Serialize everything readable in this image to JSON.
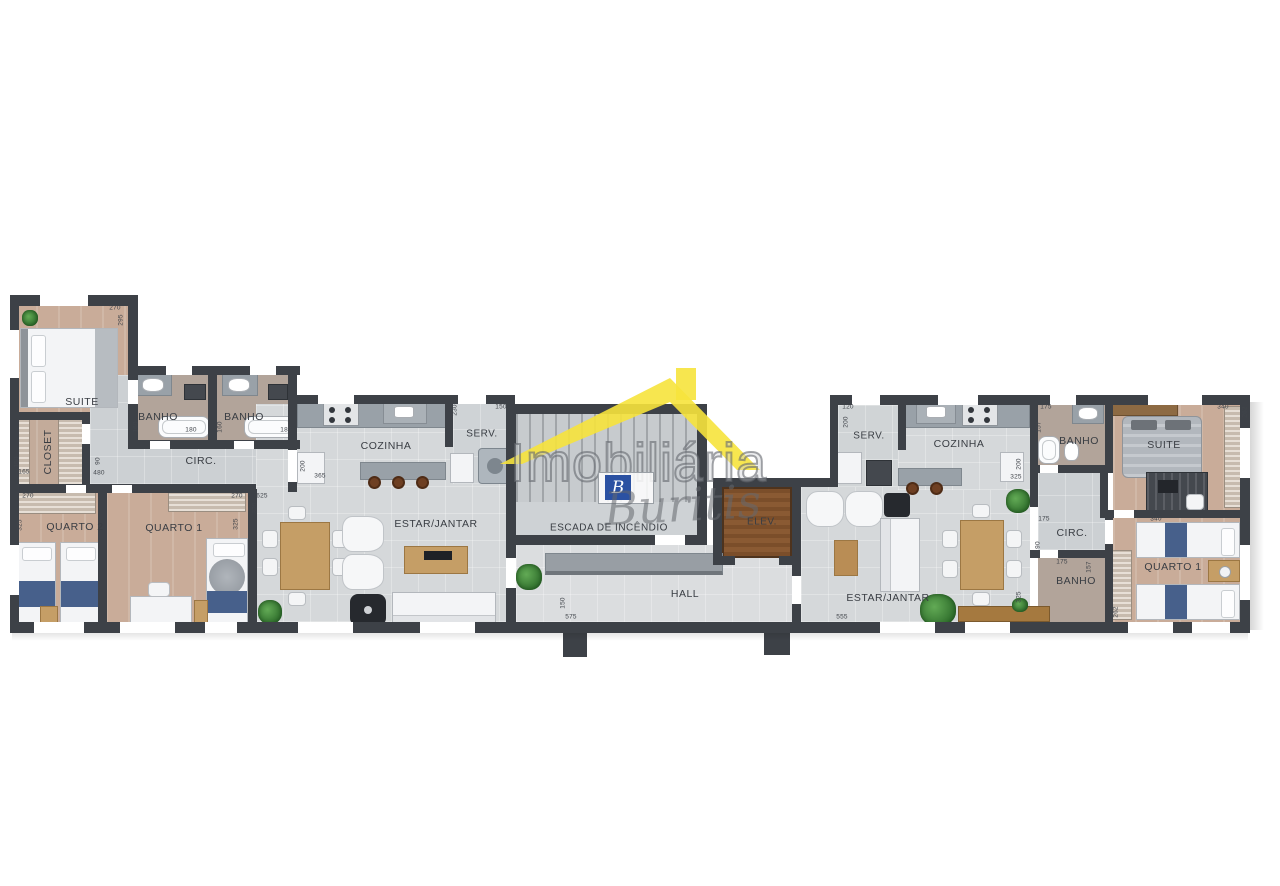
{
  "watermark": {
    "brand": "Imobiliária",
    "script": "Buritis",
    "logo_letter": "B",
    "roof_color": "#F6E33C",
    "logo_blue": "#2B51A2"
  },
  "room_labels": [
    {
      "t": "SUITE",
      "x": 82,
      "y": 402
    },
    {
      "t": "CLOSET",
      "x": 48,
      "y": 452,
      "v": true
    },
    {
      "t": "BANHO",
      "x": 158,
      "y": 417
    },
    {
      "t": "BANHO",
      "x": 244,
      "y": 417
    },
    {
      "t": "CIRC.",
      "x": 201,
      "y": 461
    },
    {
      "t": "QUARTO 2",
      "x": 75,
      "y": 527
    },
    {
      "t": "QUARTO 1",
      "x": 174,
      "y": 528
    },
    {
      "t": "COZINHA",
      "x": 386,
      "y": 446
    },
    {
      "t": "SERV.",
      "x": 482,
      "y": 434,
      "s": 10
    },
    {
      "t": "ESTAR/JANTAR",
      "x": 436,
      "y": 524
    },
    {
      "t": "ESCADA DE INCÊNDIO",
      "x": 609,
      "y": 528,
      "s": 10
    },
    {
      "t": "ELEV.",
      "x": 762,
      "y": 522,
      "s": 10
    },
    {
      "t": "HALL",
      "x": 685,
      "y": 594
    },
    {
      "t": "SERV.",
      "x": 869,
      "y": 436,
      "s": 10
    },
    {
      "t": "COZINHA",
      "x": 959,
      "y": 444
    },
    {
      "t": "BANHO",
      "x": 1079,
      "y": 441
    },
    {
      "t": "SUITE",
      "x": 1164,
      "y": 445
    },
    {
      "t": "CIRC.",
      "x": 1072,
      "y": 533
    },
    {
      "t": "BANHO",
      "x": 1076,
      "y": 581
    },
    {
      "t": "QUARTO 1",
      "x": 1173,
      "y": 567
    },
    {
      "t": "ESTAR/JANTAR",
      "x": 888,
      "y": 598
    }
  ],
  "dims": [
    {
      "t": "270",
      "x": 115,
      "y": 308
    },
    {
      "t": "295",
      "x": 121,
      "y": 320,
      "v": true
    },
    {
      "t": "150",
      "x": 17,
      "y": 462,
      "v": true
    },
    {
      "t": "165",
      "x": 24,
      "y": 472
    },
    {
      "t": "270",
      "x": 28,
      "y": 496
    },
    {
      "t": "325",
      "x": 20,
      "y": 525,
      "v": true
    },
    {
      "t": "160",
      "x": 136,
      "y": 427,
      "v": true
    },
    {
      "t": "180",
      "x": 191,
      "y": 430
    },
    {
      "t": "160",
      "x": 220,
      "y": 427,
      "v": true
    },
    {
      "t": "180",
      "x": 286,
      "y": 430
    },
    {
      "t": "90",
      "x": 98,
      "y": 461,
      "v": true
    },
    {
      "t": "480",
      "x": 99,
      "y": 473
    },
    {
      "t": "270",
      "x": 237,
      "y": 496
    },
    {
      "t": "325",
      "x": 236,
      "y": 524,
      "v": true
    },
    {
      "t": "625",
      "x": 262,
      "y": 496
    },
    {
      "t": "325",
      "x": 255,
      "y": 508,
      "v": true
    },
    {
      "t": "200",
      "x": 303,
      "y": 466,
      "v": true
    },
    {
      "t": "365",
      "x": 320,
      "y": 476
    },
    {
      "t": "230",
      "x": 455,
      "y": 410,
      "v": true
    },
    {
      "t": "150",
      "x": 501,
      "y": 407
    },
    {
      "t": "150",
      "x": 563,
      "y": 603,
      "v": true
    },
    {
      "t": "575",
      "x": 571,
      "y": 617
    },
    {
      "t": "120",
      "x": 848,
      "y": 407
    },
    {
      "t": "200",
      "x": 846,
      "y": 422,
      "v": true
    },
    {
      "t": "175",
      "x": 1046,
      "y": 407
    },
    {
      "t": "157",
      "x": 1039,
      "y": 427,
      "v": true
    },
    {
      "t": "340",
      "x": 1223,
      "y": 407
    },
    {
      "t": "262",
      "x": 1245,
      "y": 412,
      "v": true
    },
    {
      "t": "200",
      "x": 1019,
      "y": 464,
      "v": true
    },
    {
      "t": "325",
      "x": 1016,
      "y": 477
    },
    {
      "t": "175",
      "x": 1044,
      "y": 519
    },
    {
      "t": "340",
      "x": 1156,
      "y": 519
    },
    {
      "t": "90",
      "x": 1038,
      "y": 545,
      "v": true
    },
    {
      "t": "175",
      "x": 1062,
      "y": 562
    },
    {
      "t": "157",
      "x": 1089,
      "y": 567,
      "v": true
    },
    {
      "t": "262",
      "x": 1116,
      "y": 612,
      "v": true
    },
    {
      "t": "325",
      "x": 1019,
      "y": 597,
      "v": true
    },
    {
      "t": "555",
      "x": 842,
      "y": 617
    }
  ]
}
